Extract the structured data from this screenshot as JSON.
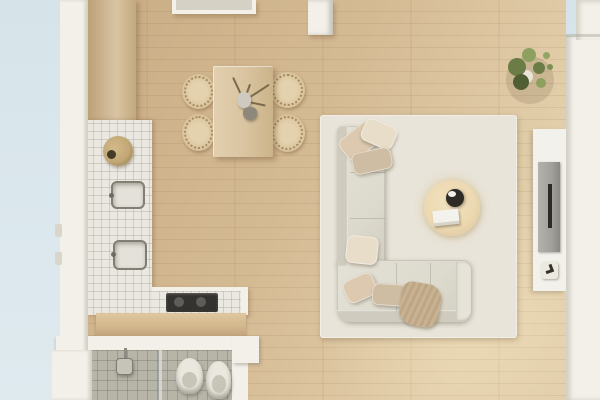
{
  "scene": {
    "type": "apartment-floor-plan-top-view",
    "description": "Top-down 3D render of a studio apartment with open kitchen, dining area, living room and bathroom",
    "rooms": [
      {
        "name": "exterior",
        "items": [
          "blue-ground"
        ]
      },
      {
        "name": "kitchen",
        "items": [
          "tall-wood-cabinet",
          "tiled-counter",
          "fruit-bowl",
          "sink",
          "second-sink",
          "cooktop",
          "breakfast-bar"
        ]
      },
      {
        "name": "dining-area",
        "items": [
          "dining-table",
          "chair",
          "chair",
          "chair",
          "chair",
          "branch-centerpiece",
          "small-vase",
          "carafe"
        ]
      },
      {
        "name": "living-room",
        "items": [
          "area-rug",
          "l-shaped-sectional-sofa",
          "throw-pillow",
          "throw-pillow",
          "throw-pillow",
          "throw-pillow",
          "throw-pillow",
          "throw-pillow",
          "throw-blanket",
          "round-coffee-table",
          "dark-vase",
          "book",
          "media-console",
          "tv",
          "decor-object",
          "potted-plant"
        ]
      },
      {
        "name": "bathroom",
        "items": [
          "shower-head",
          "glass-partition",
          "toilet",
          "bidet"
        ]
      },
      {
        "name": "hallway",
        "items": [
          "console-table",
          "pillar"
        ]
      }
    ]
  },
  "palette": {
    "exterior": "#d6e4ea",
    "exteriorLight": "#dfeaef",
    "wallWhite": "#f2f0e9",
    "wallShadow": "#d9d5c9",
    "floorDark": "#c8ab83",
    "floorMid": "#d4ba93",
    "floorLight": "#e3cfab",
    "plankLine": "rgba(110,78,45,0.10)",
    "cabinetWood": "#cdb693",
    "tile": "#eae8e1",
    "tileLine": "rgba(160,155,140,0.35)",
    "barWood": "#d3b78d",
    "bowlTan": "#c2a875",
    "cooktop": "#35332f",
    "bathTile": "#b7b5a8",
    "bathTileLine": "rgba(95,95,85,0.30)",
    "fixture": "#eae8de",
    "glass": "rgba(235,240,238,0.55)",
    "tableWood": "#d9c4a0",
    "chairWood": "#d8c29b",
    "rug": "#e8e4d9",
    "sofa": "#dddace",
    "sofaEdge": "#cfccbf",
    "pillowA": "#dcc9b0",
    "pillowB": "#e7ddc9",
    "pillowC": "#cfbda3",
    "blanket": "#c8b292",
    "coffeeTable": "#ecd9b2",
    "vaseDark": "#2e2b26",
    "bookWhite": "#f4f2ec",
    "console": "#f3f1eb",
    "tvPanel": "#a3a19b",
    "tvDark": "#2c2b28",
    "plantDark": "#4f5e33",
    "plantMid": "#6b7c46",
    "plantLight": "#8da05e",
    "pot": "#e9e5d8"
  }
}
